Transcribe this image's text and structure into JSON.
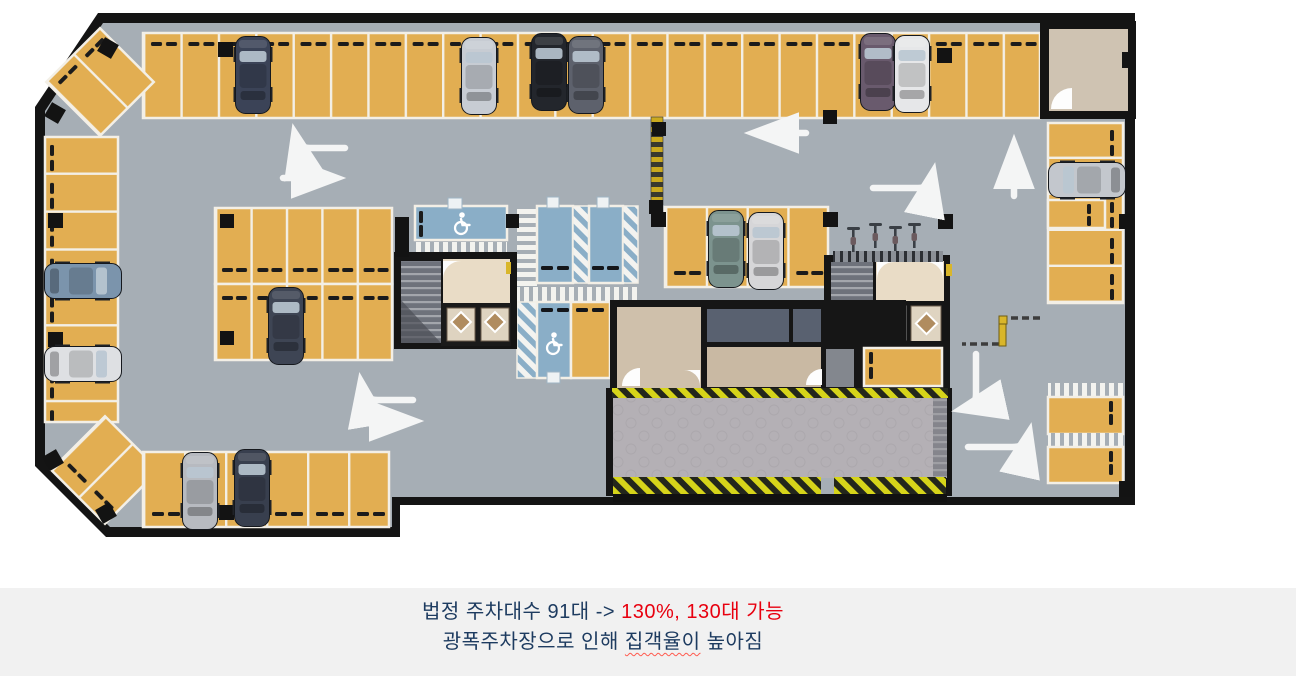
{
  "caption": {
    "line1": {
      "prefix": "법정 주차대수 91대 ->",
      "highlight": "130%, 130대 가능"
    },
    "line2": {
      "prefix": "광폭주차장으로 인해",
      "underlined": "집객율이",
      "suffix": "높아짐"
    }
  },
  "colors": {
    "caption_text": "#1d3b60",
    "caption_highlight": "#e8000f",
    "caption_band": "#f1f1f1",
    "floor": "#a6aeb5",
    "wall": "#141414",
    "stall_fill": "#e2ae52",
    "stall_line": "#f3efe6",
    "accessible_blue": "#8aaec7",
    "hazard_yellow": "#d6d41a",
    "ramp_concrete": "#b4b0b5",
    "room_beige": "#cfc0ab",
    "room_dark": "#596170"
  },
  "icons": {
    "wheelchair-icon": "drawn white wheelchair glyph",
    "direction-arrow-icon": "white painted lane arrow",
    "speed-bump-icon": "yellow/black striped bar",
    "parking-gate-icon": "dashed barrier with yellow posts",
    "bicycle-icon": "top-view bicycle at rack",
    "elevator-icon": "diamond pattern cab",
    "stairs-icon": "treaded stairwell"
  }
}
